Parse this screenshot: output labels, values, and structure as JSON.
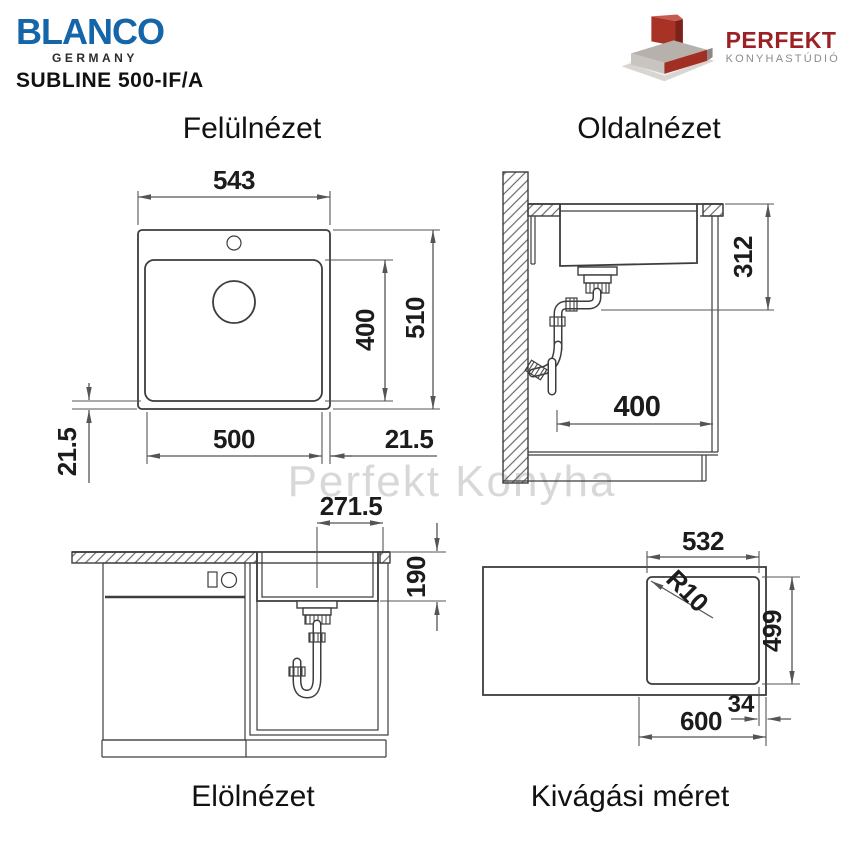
{
  "header": {
    "brand": "BLANCO",
    "country": "GERMANY",
    "model": "SUBLINE 500-IF/A"
  },
  "partner": {
    "name": "PERFEKT",
    "subtitle": "KONYHASTÚDIÓ"
  },
  "watermark": {
    "text": "Perfekt Konyha"
  },
  "colors": {
    "brand_blue": "#1565a9",
    "partner_red": "#9c2125",
    "partner_gray": "#8c8c8c",
    "line": "#3d3d3d",
    "dim": "#555555",
    "ink": "#1c1c1c",
    "wm": "#d8d8d8"
  },
  "views": {
    "top": {
      "title": "Felülnézet",
      "dims": {
        "outer_width": "543",
        "outer_depth": "510",
        "bowl_width": "500",
        "bowl_depth": "400",
        "rim_left": "21.5",
        "rim_right": "21.5"
      }
    },
    "side": {
      "title": "Oldalnézet",
      "dims": {
        "under_counter_depth": "312",
        "base_clearance": "400"
      }
    },
    "front": {
      "title": "Elölnézet",
      "dims": {
        "drain_center_offset": "271.5",
        "bowl_inner_depth": "190"
      }
    },
    "cutout": {
      "title": "Kivágási méret",
      "dims": {
        "cutout_width": "532",
        "cutout_depth": "499",
        "corner_radius": "R10",
        "cabinet_width": "600",
        "side_offset": "34"
      }
    }
  }
}
